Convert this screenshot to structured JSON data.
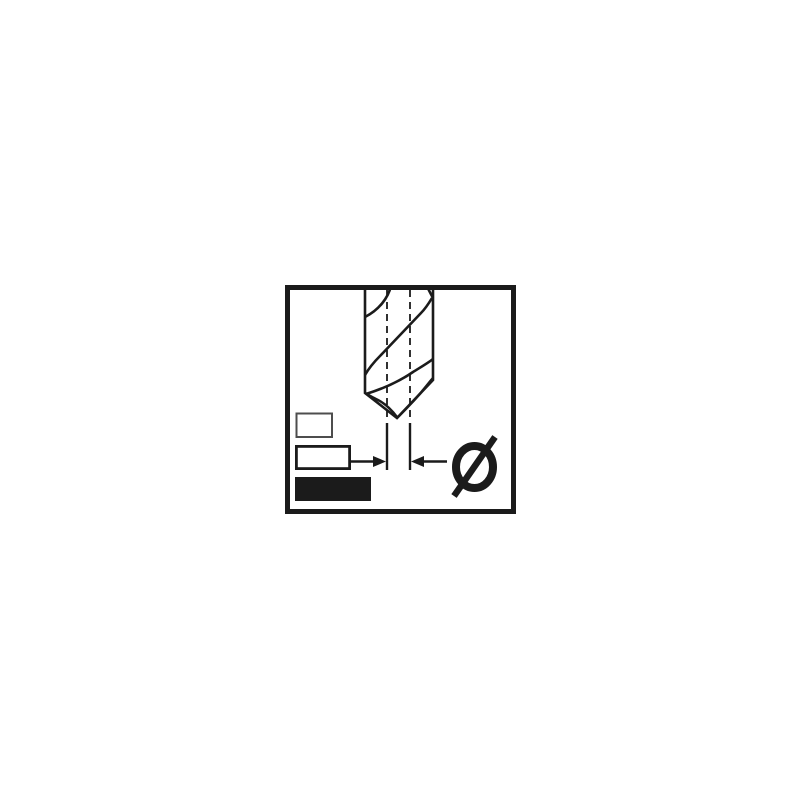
{
  "canvas": {
    "background": "#ffffff"
  },
  "pictogram": {
    "name": "drill-bit-diameter-pictogram",
    "diameter_symbol": "Ø",
    "colors": {
      "line": "#1b1b1b",
      "background": "#ffffff",
      "small_rect_stroke": "#4d4d4d"
    },
    "icons": [
      {
        "name": "twist-drill-bit-icon"
      },
      {
        "name": "centerline-dashed-icon"
      },
      {
        "name": "diameter-dimension-arrows-icon"
      },
      {
        "name": "size-rectangle-small-icon"
      },
      {
        "name": "size-rectangle-medium-icon"
      },
      {
        "name": "size-rectangle-large-filled-icon"
      },
      {
        "name": "diameter-symbol-icon",
        "glyph": "Ø"
      }
    ]
  }
}
